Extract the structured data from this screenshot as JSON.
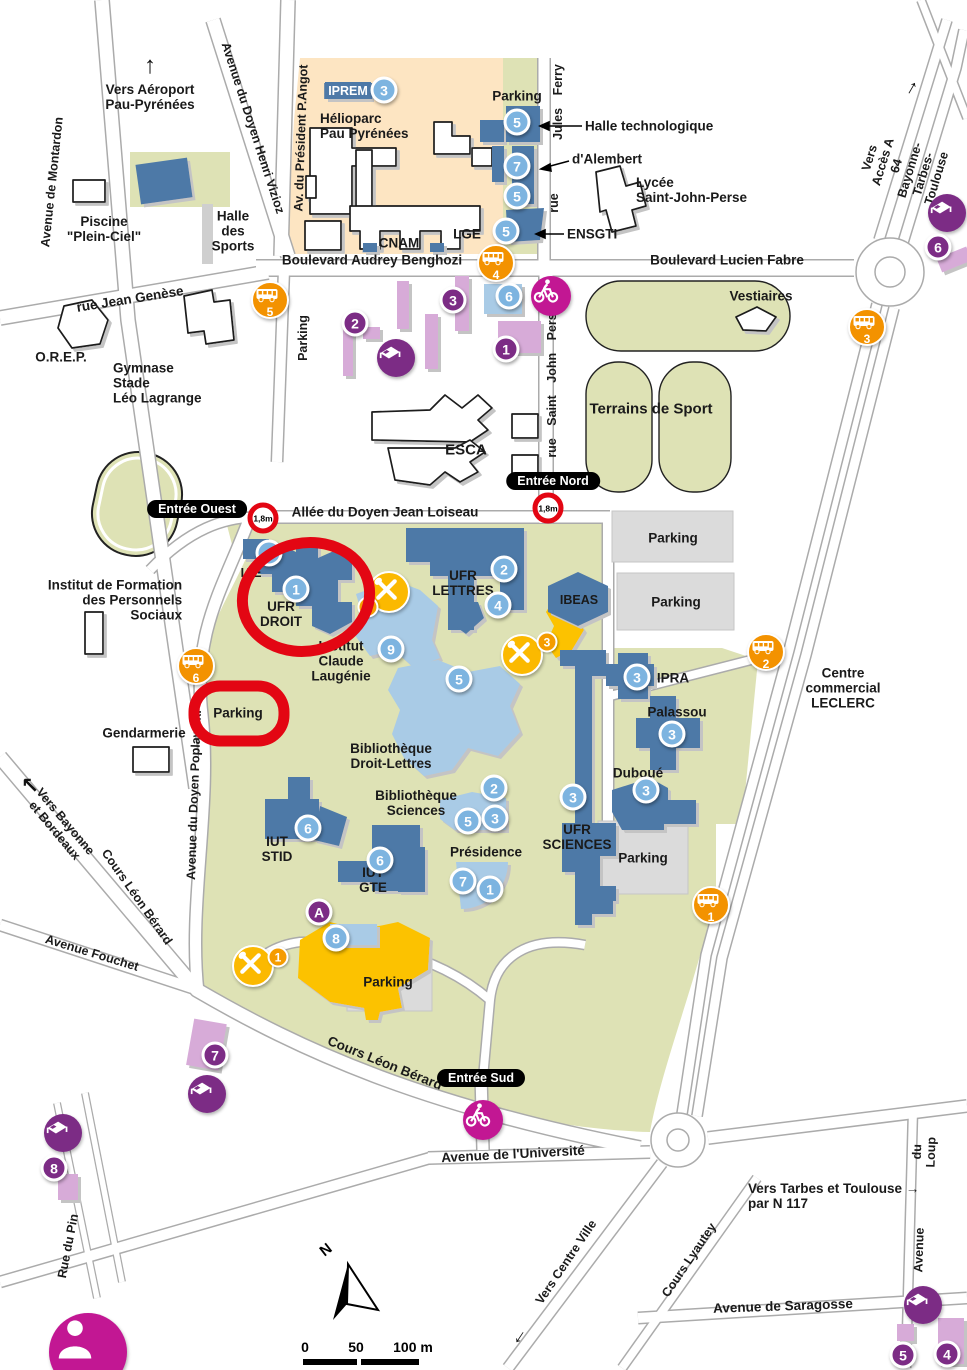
{
  "colors": {
    "campus_green": "#dee2b5",
    "helioparc_peach": "#fde5c2",
    "building_blue": "#4e79a7",
    "building_lightblue": "#a9cbe6",
    "building_lavender": "#d7abd8",
    "marker_blue": "#7db4e0",
    "marker_purple": "#7c2c85",
    "bus_orange": "#f39200",
    "restaurant_yellow": "#fbb900",
    "annotation_red": "#e30613",
    "bike_magenta": "#c21793",
    "parking_gray": "#dbdbdb"
  },
  "streets": {
    "aeroport": "Vers Aéroport\nPau-Pyrénées",
    "montardon": "Avenue de Montardon",
    "vizioz": "Avenue du Doyen Henri Vizioz",
    "angot": "Av. du Président P.Angot",
    "jules_ferry": "Jules  Ferry",
    "jules_ferry_rue": "rue",
    "benghozi": "Boulevard Audrey Benghozi",
    "fabre": "Boulevard Lucien Fabre",
    "a64": "Vers Accès A 64\nBayonne-Tarbes-Toulouse",
    "genese": "rue Jean Genèse",
    "sjperse": "rue  Saint  John  Perse",
    "loiseau": "Allée du Doyen Jean Loiseau",
    "poplawski": "Avenue du Doyen Poplawski",
    "bayonne": "Vers Bayonne\net Bordeaux",
    "leon_berard": "Cours Léon Bérard",
    "fouchet": "Avenue Fouchet",
    "universite": "Avenue de l'Université",
    "centre_ville": "Vers Centre Ville",
    "lyautey": "Cours Lyautey",
    "saragosse": "Avenue de Saragosse",
    "loup_top": "du Loup",
    "loup_bottom": "Avenue",
    "pin": "Rue du Pin",
    "tarbes": "Vers Tarbes et Toulouse →\npar N 117",
    "arrow_up": "↑",
    "arrow_nw": "↖",
    "arrow_left": "←"
  },
  "places": {
    "piscine": "Piscine\n\"Plein-Ciel\"",
    "halle_sports": "Halle\ndes\nSports",
    "iprem": "IPREM",
    "helioparc": "Hélioparc\nPau Pyrénées",
    "parking": "Parking",
    "halle_tech": "Halle technologique",
    "alembert": "d'Alembert",
    "lycee": "Lycée\nSaint-John-Perse",
    "ensgti": "ENSGTI",
    "lge": "LGE",
    "cnam": "CNAM",
    "orep": "O.R.E.P.",
    "gymnase": "Gymnase\nStade\nLéo Lagrange",
    "vestiaires": "Vestiaires",
    "terrains": "Terrains de Sport",
    "esca": "ESCA",
    "ifps": "Institut de Formation\ndes Personnels\nSociaux",
    "iae": "IAE",
    "ufr_droit": "UFR\nDROIT",
    "ufr_lettres": "UFR\nLETTRES",
    "ibeas": "IBEAS",
    "laugenie": "Institut\nClaude\nLaugénie",
    "bib_dl": "Bibliothèque\nDroit-Lettres",
    "bib_sci": "Bibliothèque\nSciences",
    "ipra": "IPRA",
    "palassou": "Palassou",
    "duboue": "Duboué",
    "ufr_sciences": "UFR\nSCIENCES",
    "presidence": "Présidence",
    "iut_stid": "IUT\nSTID",
    "iut_gte": "IUT\nGTE",
    "gendarmerie": "Gendarmerie",
    "leclerc": "Centre\ncommercial\nLECLERC"
  },
  "entrances": {
    "ouest": "Entrée Ouest",
    "nord": "Entrée Nord",
    "sud": "Entrée Sud"
  },
  "height_limit": "1,8m",
  "markers": {
    "iprem": "3",
    "helio_a": "5",
    "helio_b": "7",
    "helio_c": "5",
    "helio_d": "5",
    "iae": "4",
    "droit": "1",
    "lettres_a": "2",
    "lettres_b": "4",
    "laugenie": "9",
    "bib_dl": "5",
    "ipra": "3",
    "palassou": "3",
    "duboue": "3",
    "ufr_sci": "3",
    "bibsci_a": "2",
    "bibsci_b": "5",
    "bibsci_c": "3",
    "presidence_a": "7",
    "presidence_b": "1",
    "stid": "6",
    "gte": "6",
    "eight": "8",
    "a": "A",
    "top6": "6"
  },
  "residences": {
    "r1": "1",
    "r2": "2",
    "r3": "3",
    "r6": "6",
    "r7": "7",
    "r8": "8",
    "r5": "5",
    "r4": "4"
  },
  "bus": {
    "b1": "1",
    "b2": "2",
    "b3": "3",
    "b4": "4",
    "b5": "5",
    "b6": "6"
  },
  "restaurants": {
    "u1": "1",
    "u2": "2",
    "u3": "3"
  },
  "scale": {
    "t0": "0",
    "t50": "50",
    "t100": "100 m"
  },
  "compass": "N"
}
